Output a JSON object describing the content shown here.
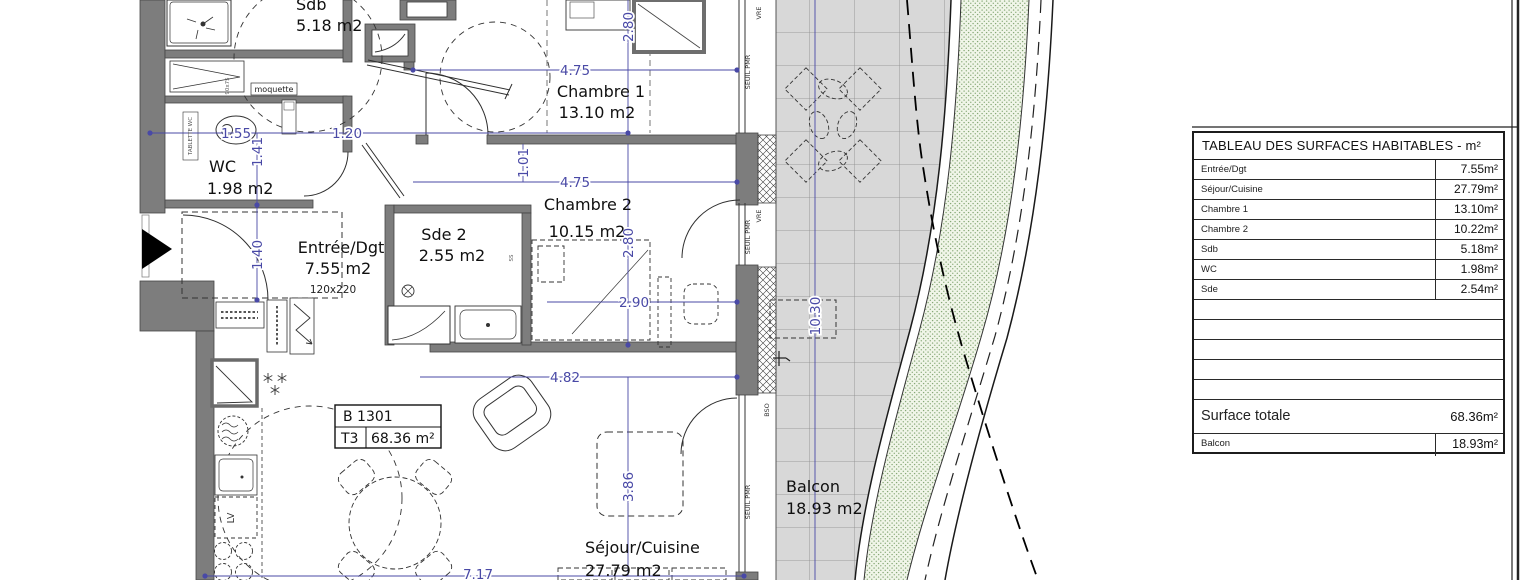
{
  "table": {
    "title": "TABLEAU DES SURFACES HABITABLES - m²",
    "rows": [
      {
        "label": "Entrée/Dgt",
        "value": "7.55m²"
      },
      {
        "label": "Séjour/Cuisine",
        "value": "27.79m²"
      },
      {
        "label": "Chambre 1",
        "value": "13.10m²"
      },
      {
        "label": "Chambre 2",
        "value": "10.22m²"
      },
      {
        "label": "Sdb",
        "value": "5.18m²"
      },
      {
        "label": "WC",
        "value": "1.98m²"
      },
      {
        "label": "Sde",
        "value": "2.54m²"
      }
    ],
    "total_row": {
      "label": "Surface totale",
      "value": "68.36m²"
    },
    "balcony_row": {
      "label": "Balcon",
      "value": "18.93m²"
    }
  },
  "plan": {
    "unit_box": {
      "code": "B 1301",
      "type": "T3",
      "area": "68.36 m²"
    },
    "rooms": {
      "sdb": {
        "name": "Sdb",
        "area": "5.18 m2"
      },
      "wc": {
        "name": "WC",
        "area": "1.98 m2"
      },
      "entree": {
        "name": "Entrée/Dgt",
        "area": "7.55 m2",
        "door_size": "120x220"
      },
      "chambre1": {
        "name": "Chambre 1",
        "area": "13.10 m2"
      },
      "chambre2": {
        "name": "Chambre 2",
        "area": "10.15 m2"
      },
      "sde2": {
        "name": "Sde 2",
        "area": "2.55 m2"
      },
      "sejour": {
        "name": "Séjour/Cuisine",
        "area": "27.79 m2"
      },
      "balcon": {
        "name": "Balcon",
        "area": "18.93 m2"
      }
    },
    "dimensions": {
      "d280a": "2.80",
      "d475a": "4.75",
      "d155": "1.55",
      "d120": "1.20",
      "d141": "1.41",
      "d140": "1.40",
      "d101": "1.01",
      "d475b": "4.75",
      "d280b": "2.80",
      "d290": "2.90",
      "d1030": "10.30",
      "d482": "4.82",
      "d386": "3.86",
      "d717": "7.17"
    },
    "wall_labels": {
      "vre1": "VRE",
      "seuil1": "SEUIL PMR",
      "vre2": "VRE",
      "seuil2": "SEUIL PMR",
      "seuil3": "SEUIL PMR",
      "bso": "BSO",
      "moquette": "moquette",
      "tablette": "TABLETTE WC",
      "lv": "LV",
      "ss": "SS",
      "shower_size": "90x75"
    }
  },
  "colors": {
    "dimension_blue": "#4949a6",
    "wall_gray": "#7d7d7d",
    "tile_gray": "#d8d8d8",
    "green_band": "#f0f5e8",
    "green_dot": "#86a876"
  }
}
